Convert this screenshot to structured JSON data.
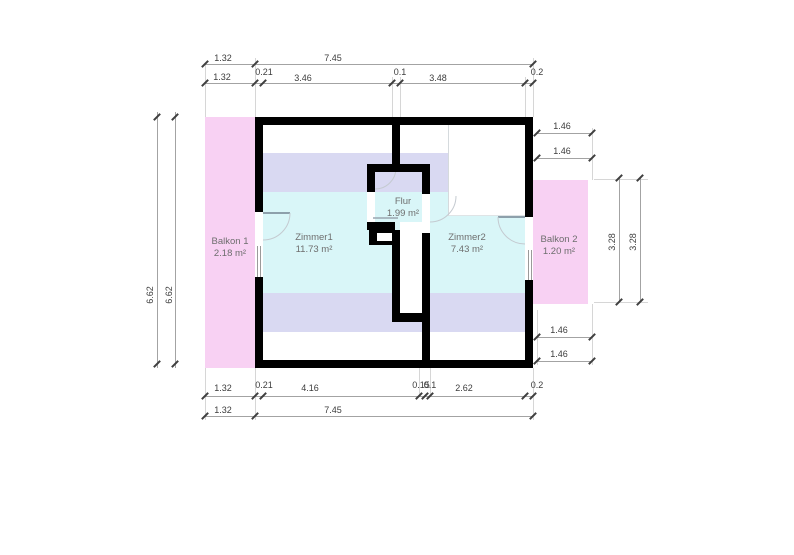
{
  "plan_type": "floor-plan",
  "rooms": {
    "balkon1": {
      "name": "Balkon 1",
      "area": "2.18 m²"
    },
    "zimmer1": {
      "name": "Zimmer1",
      "area": "11.73 m²"
    },
    "flur": {
      "name": "Flur",
      "area": "1.99 m²"
    },
    "zimmer2": {
      "name": "Zimmer2",
      "area": "7.43 m²"
    },
    "balkon2": {
      "name": "Balkon 2",
      "area": "1.20 m²"
    }
  },
  "dimensions": {
    "top_outer": {
      "balkon": "1.32",
      "total": "7.45"
    },
    "top_inner": {
      "balkon": "1.32",
      "wall_left": "0.21",
      "zimmer1": "3.46",
      "partition": "0.1",
      "zimmer2": "3.48",
      "wall_right": "0.2"
    },
    "bottom_inner": {
      "balkon": "1.32",
      "wall_left": "0.21",
      "zimmer1": "4.16",
      "stair_a": "0.15",
      "stair_b": "0.1",
      "zimmer2": "2.62",
      "wall_right": "0.2"
    },
    "bottom_outer": {
      "balkon": "1.32",
      "total": "7.45"
    },
    "left": [
      "6.62",
      "6.62"
    ],
    "right_top": [
      "1.46",
      "1.46"
    ],
    "right_middle": [
      "3.28",
      "3.28"
    ],
    "right_bottom": [
      "1.46",
      "1.46"
    ]
  },
  "colors": {
    "wall": "#000000",
    "balcony_fill": "#F8D1F3",
    "sloped_area_fill": "#D9D9F2",
    "room_fill": "#D9F6F8",
    "dimension_text": "#3C3C3C",
    "room_text": "#6E6E6E"
  }
}
